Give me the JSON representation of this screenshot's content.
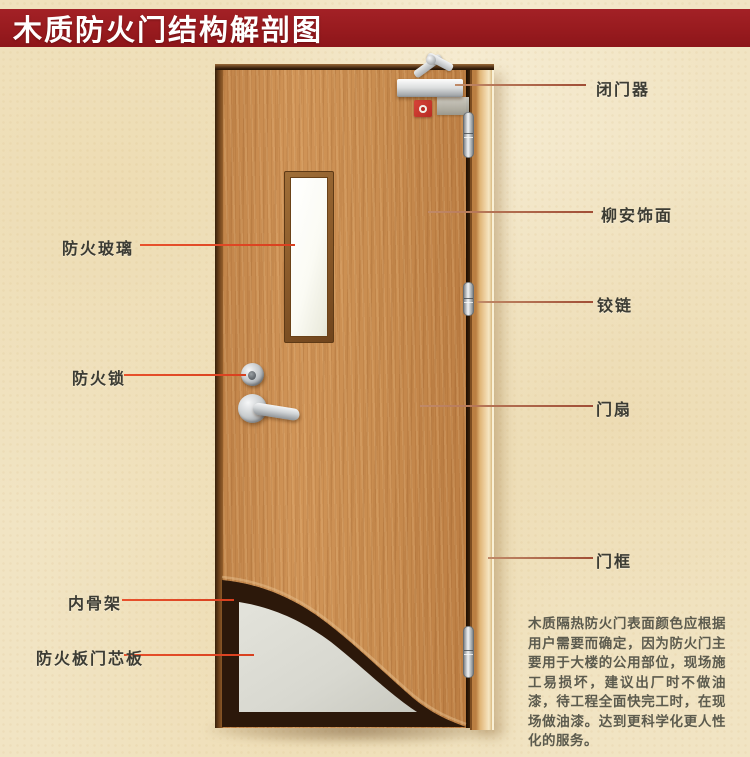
{
  "title": "木质防火门结构解剖图",
  "labels": {
    "left": [
      {
        "text": "防火玻璃"
      },
      {
        "text": "防火锁"
      },
      {
        "text": "内骨架"
      },
      {
        "text": "防火板门芯板"
      }
    ],
    "right": [
      {
        "text": "闭门器"
      },
      {
        "text": "柳安饰面"
      },
      {
        "text": "铰链"
      },
      {
        "text": "门扇"
      },
      {
        "text": "门框"
      }
    ]
  },
  "description": "木质隔热防火门表面颜色应根据用户需要而确定，因为防火门主要用于大楼的公用部位，现场施工易损坏，建议出厂时不做油漆，待工程全面快完工时，在现场做油漆。达到更科学化更人性化的服务。",
  "colors": {
    "title_bar": "#9e1e22",
    "leader_line_left": "#e0482a",
    "leader_line_right": "#a8573f",
    "label_text": "#3c3c34",
    "door_wood": "#c68a4e",
    "door_frame": "#e0b577",
    "core_panel": "#d9d9d1",
    "inner_skeleton": "#2f1a0c",
    "background": "#f1e4c3"
  }
}
